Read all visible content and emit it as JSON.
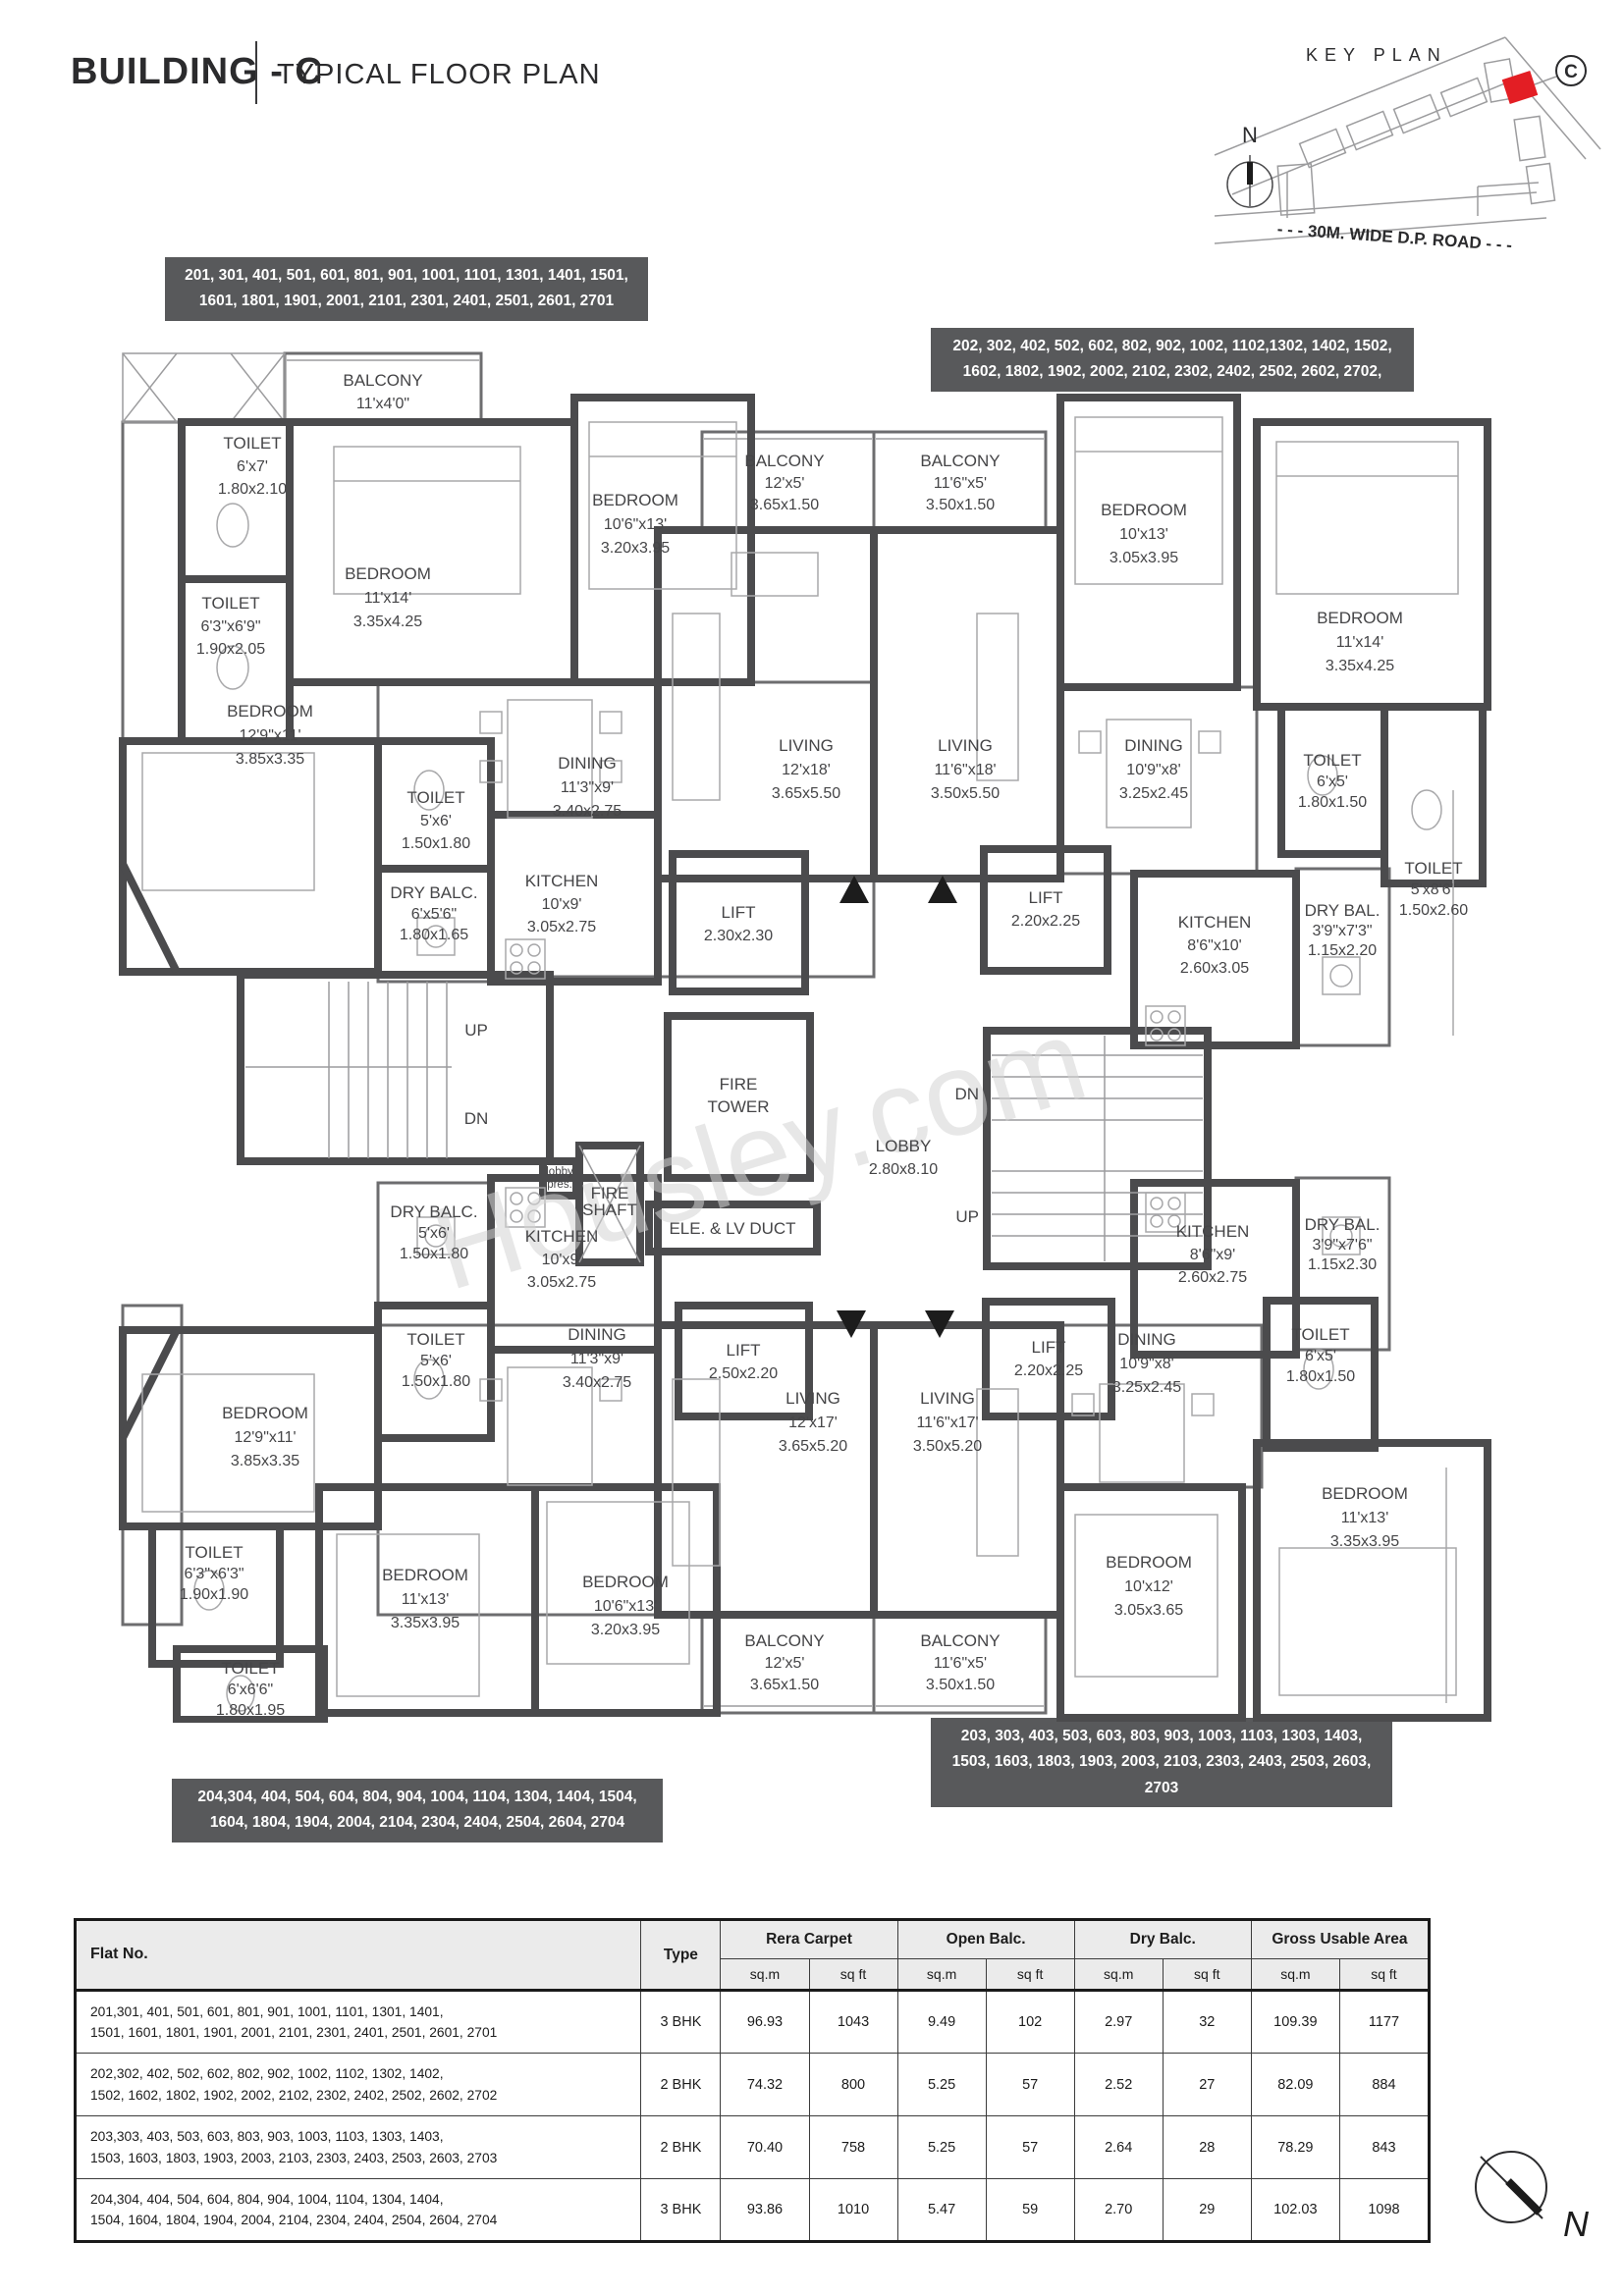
{
  "header": {
    "building": "BUILDING - C",
    "subtitle": "TYPICAL FLOOR PLAN"
  },
  "key_plan": {
    "title": "KEY PLAN",
    "north_label": "N",
    "building_label": "C",
    "road_label": "- - - 30M. WIDE D.P. ROAD - - -",
    "highlight_color": "#e31e24"
  },
  "watermark": "Housley.com",
  "flat_boxes": {
    "top_left": "201, 301, 401, 501, 601, 801, 901, 1001, 1101, 1301, 1401, 1501, 1601, 1801, 1901, 2001, 2101, 2301, 2401, 2501, 2601, 2701",
    "top_right": "202, 302, 402, 502, 602, 802, 902, 1002, 1102,1302, 1402, 1502, 1602, 1802, 1902, 2002, 2102, 2302, 2402, 2502, 2602, 2702,",
    "bottom_right": "203, 303, 403, 503, 603, 803, 903, 1003, 1103, 1303, 1403, 1503, 1603, 1803, 1903, 2003, 2103, 2303, 2403, 2503, 2603, 2703",
    "bottom_left": "204,304, 404, 504, 604, 804, 904, 1004, 1104, 1304, 1404, 1504, 1604, 1804, 1904, 2004, 2104, 2304, 2404, 2504, 2604, 2704"
  },
  "plan": {
    "up": "UP",
    "dn": "DN"
  },
  "rooms": {
    "balcony_tl": {
      "n": "BALCONY",
      "d": "11'x4'0\"",
      "m": ""
    },
    "toilet_6x7": {
      "n": "TOILET",
      "d": "6'x7'",
      "m": "1.80x2.10"
    },
    "bedroom_11x14_l": {
      "n": "BEDROOM",
      "d": "11'x14'",
      "m": "3.35x4.25"
    },
    "toilet_6369": {
      "n": "TOILET",
      "d": "6'3\"x6'9\"",
      "m": "1.90x2.05"
    },
    "bedroom_129_t": {
      "n": "BEDROOM",
      "d": "12'9\"x11'",
      "m": "3.85x3.35"
    },
    "bedroom_1063_t": {
      "n": "BEDROOM",
      "d": "10'6\"x13'",
      "m": "3.20x3.95"
    },
    "toilet_5x6_t": {
      "n": "TOILET",
      "d": "5'x6'",
      "m": "1.50x1.80"
    },
    "dining_113_t": {
      "n": "DINING",
      "d": "11'3\"x9'",
      "m": "3.40x2.75"
    },
    "dry_balc_656": {
      "n": "DRY BALC.",
      "d": "6'x5'6\"",
      "m": "1.80x1.65"
    },
    "kitchen_109_t": {
      "n": "KITCHEN",
      "d": "10'x9'",
      "m": "3.05x2.75"
    },
    "balcony_12x5_t": {
      "n": "BALCONY",
      "d": "12'x5'",
      "m": "3.65x1.50"
    },
    "living_12x18": {
      "n": "LIVING",
      "d": "12'x18'",
      "m": "3.65x5.50"
    },
    "balcony_1165_t": {
      "n": "BALCONY",
      "d": "11'6\"x5'",
      "m": "3.50x1.50"
    },
    "living_1165x18": {
      "n": "LIVING",
      "d": "11'6\"x18'",
      "m": "3.50x5.50"
    },
    "bedroom_10x13": {
      "n": "BEDROOM",
      "d": "10'x13'",
      "m": "3.05x3.95"
    },
    "dining_109_t": {
      "n": "DINING",
      "d": "10'9\"x8'",
      "m": "3.25x2.45"
    },
    "bedroom_11x14_r": {
      "n": "BEDROOM",
      "d": "11'x14'",
      "m": "3.35x4.25"
    },
    "toilet_6x5_tr": {
      "n": "TOILET",
      "d": "6'x5'",
      "m": "1.80x1.50"
    },
    "toilet_5x86": {
      "n": "TOILET",
      "d": "5'x8'6\"",
      "m": "1.50x2.60"
    },
    "kitchen_8610": {
      "n": "KITCHEN",
      "d": "8'6\"x10'",
      "m": "2.60x3.05"
    },
    "dry_bal_3973": {
      "n": "DRY BAL.",
      "d": "3'9\"x7'3\"",
      "m": "1.15x2.20"
    },
    "lift_230": {
      "n": "LIFT",
      "m": "2.30x2.30"
    },
    "lift_220_t": {
      "n": "LIFT",
      "m": "2.20x2.25"
    },
    "fire_tower": {
      "n": "FIRE",
      "m": "TOWER"
    },
    "lobby": {
      "n": "LOBBY",
      "m": "2.80x8.10"
    },
    "lobby_pres": {
      "n": "lobby",
      "m": "pres."
    },
    "fire_shaft": {
      "n": "FIRE",
      "m": "SHAFT"
    },
    "ele_duct": {
      "n": "ELE. & LV DUCT"
    },
    "lift_250": {
      "n": "LIFT",
      "m": "2.50x2.20"
    },
    "lift_220_b": {
      "n": "LIFT",
      "m": "2.20x2.25"
    },
    "dry_balc_5x6": {
      "n": "DRY BALC.",
      "d": "5'x6'",
      "m": "1.50x1.80"
    },
    "kitchen_109_b": {
      "n": "KITCHEN",
      "d": "10'x9'",
      "m": "3.05x2.75"
    },
    "toilet_5x6_b": {
      "n": "TOILET",
      "d": "5'x6'",
      "m": "1.50x1.80"
    },
    "dining_113_b": {
      "n": "DINING",
      "d": "11'3\"x9'",
      "m": "3.40x2.75"
    },
    "bedroom_129_b": {
      "n": "BEDROOM",
      "d": "12'9\"x11'",
      "m": "3.85x3.35"
    },
    "toilet_6363": {
      "n": "TOILET",
      "d": "6'3\"x6'3\"",
      "m": "1.90x1.90"
    },
    "toilet_6x66": {
      "n": "TOILET",
      "d": "6'x6'6\"",
      "m": "1.80x1.95"
    },
    "bedroom_1113_bl": {
      "n": "BEDROOM",
      "d": "11'x13'",
      "m": "3.35x3.95"
    },
    "bedroom_1063_b": {
      "n": "BEDROOM",
      "d": "10'6\"x13'",
      "m": "3.20x3.95"
    },
    "living_12x17": {
      "n": "LIVING",
      "d": "12'x17'",
      "m": "3.65x5.20"
    },
    "living_1165x17": {
      "n": "LIVING",
      "d": "11'6\"x17'",
      "m": "3.50x5.20"
    },
    "balcony_12x5_b": {
      "n": "BALCONY",
      "d": "12'x5'",
      "m": "3.65x1.50"
    },
    "balcony_1165_b": {
      "n": "BALCONY",
      "d": "11'6\"x5'",
      "m": "3.50x1.50"
    },
    "kitchen_869": {
      "n": "KITCHEN",
      "d": "8'6\"x9'",
      "m": "2.60x2.75"
    },
    "dry_bal_3976": {
      "n": "DRY BAL.",
      "d": "3'9\"x7'6\"",
      "m": "1.15x2.30"
    },
    "dining_109_b": {
      "n": "DINING",
      "d": "10'9\"x8'",
      "m": "3.25x2.45"
    },
    "toilet_6x5_br": {
      "n": "TOILET",
      "d": "6'x5'",
      "m": "1.80x1.50"
    },
    "bedroom_10x12": {
      "n": "BEDROOM",
      "d": "10'x12'",
      "m": "3.05x3.65"
    },
    "bedroom_1113_br": {
      "n": "BEDROOM",
      "d": "11'x13'",
      "m": "3.35x3.95"
    }
  },
  "table": {
    "headers": {
      "flat_no": "Flat No.",
      "type": "Type",
      "rera": "Rera Carpet",
      "open_balc": "Open Balc.",
      "dry_balc": "Dry Balc.",
      "gross": "Gross Usable Area",
      "sqm": "sq.m",
      "sqft": "sq ft"
    },
    "rows": [
      {
        "flats": "201,301, 401, 501, 601, 801, 901, 1001, 1101, 1301, 1401,\n1501, 1601, 1801, 1901, 2001, 2101, 2301, 2401, 2501, 2601, 2701",
        "type": "3 BHK",
        "v0": "96.93",
        "v1": "1043",
        "v2": "9.49",
        "v3": "102",
        "v4": "2.97",
        "v5": "32",
        "v6": "109.39",
        "v7": "1177"
      },
      {
        "flats": "202,302, 402, 502, 602, 802, 902, 1002, 1102, 1302, 1402,\n1502, 1602, 1802, 1902, 2002, 2102, 2302, 2402, 2502, 2602, 2702",
        "type": "2 BHK",
        "v0": "74.32",
        "v1": "800",
        "v2": "5.25",
        "v3": "57",
        "v4": "2.52",
        "v5": "27",
        "v6": "82.09",
        "v7": "884"
      },
      {
        "flats": "203,303, 403, 503, 603, 803, 903, 1003, 1103, 1303, 1403,\n1503, 1603, 1803, 1903, 2003, 2103, 2303, 2403, 2503, 2603, 2703",
        "type": "2 BHK",
        "v0": "70.40",
        "v1": "758",
        "v2": "5.25",
        "v3": "57",
        "v4": "2.64",
        "v5": "28",
        "v6": "78.29",
        "v7": "843"
      },
      {
        "flats": "204,304, 404, 504, 604, 804, 904, 1004, 1104, 1304, 1404,\n1504, 1604, 1804, 1904, 2004, 2104, 2304, 2404, 2504, 2604, 2704",
        "type": "3 BHK",
        "v0": "93.86",
        "v1": "1010",
        "v2": "5.47",
        "v3": "59",
        "v4": "2.70",
        "v5": "29",
        "v6": "102.03",
        "v7": "1098"
      }
    ]
  }
}
